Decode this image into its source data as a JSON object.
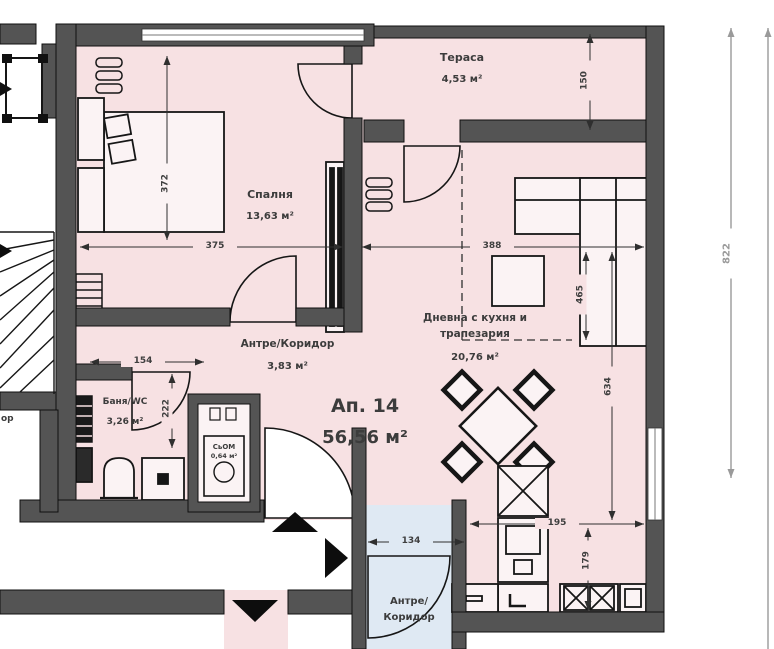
{
  "apartment": {
    "number": "Ап. 14",
    "area": "56,56 м²"
  },
  "rooms": {
    "terrace": {
      "name": "Тераса",
      "area": "4,53 м²"
    },
    "bedroom": {
      "name": "Спалня",
      "area": "13,63 м²"
    },
    "living": {
      "line1": "Дневна с кухня и",
      "line2": "трапезария",
      "area": "20,76 м²"
    },
    "hall": {
      "name": "Антре/Коридор",
      "area": "3,83 м²"
    },
    "bath": {
      "name": "Баня/WC",
      "area": "3,26 м²"
    },
    "closet": {
      "name": "СьОМ",
      "area": "0,64 м²"
    },
    "entry": {
      "line1": "Антре/",
      "line2": "Коридор"
    },
    "neighbor_fragment": "ор"
  },
  "dimensions": {
    "d375": "375",
    "d388": "388",
    "d372": "372",
    "d150": "150",
    "d465": "465",
    "d634": "634",
    "d195": "195",
    "d179": "179",
    "d154": "154",
    "d222": "222",
    "d134": "134",
    "d822": "822"
  },
  "colors": {
    "apartment_fill": "#f7e1e3",
    "entry_fill": "#dfe9f3",
    "wall": "#545454",
    "line": "#161616",
    "dim_text": "#3f3f3f",
    "overall_dim": "#9a9a9a"
  }
}
